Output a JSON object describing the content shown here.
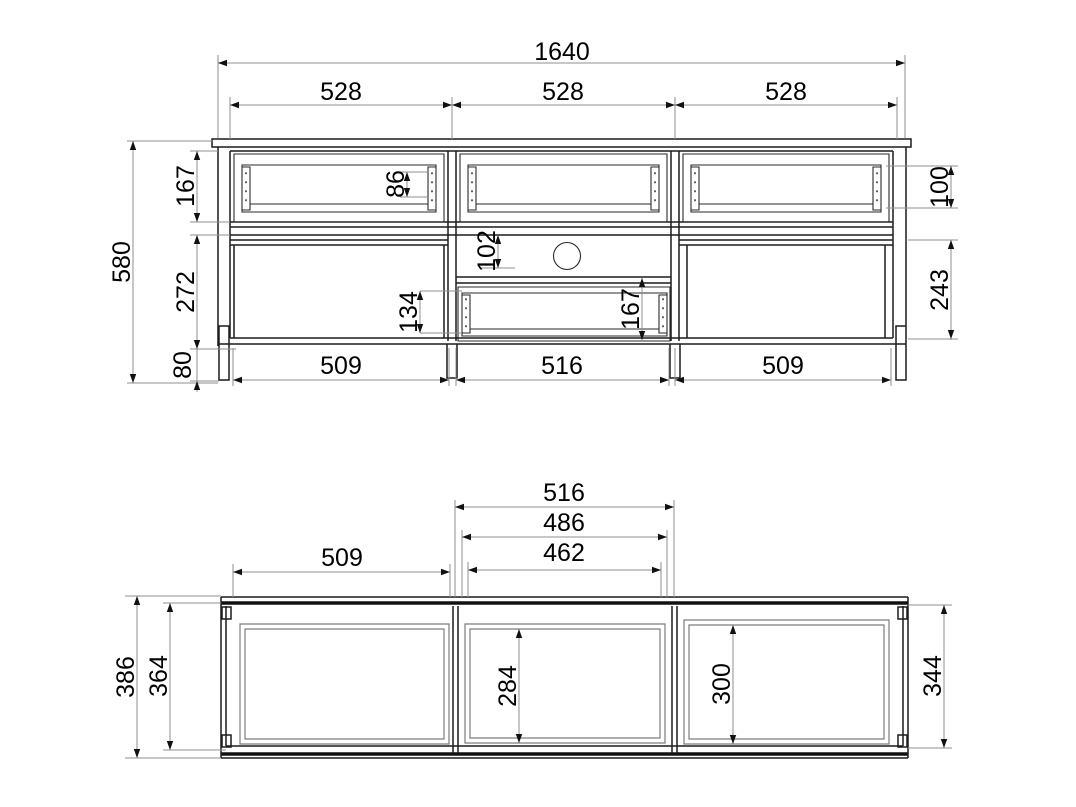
{
  "drawing": {
    "front_view": {
      "total_width": "1640",
      "section_widths": [
        "528",
        "528",
        "528"
      ],
      "total_height": "580",
      "top_section_height": "167",
      "middle_section_height": "272",
      "leg_height": "80",
      "drawer_rail_height": "86",
      "right_opening_height": "100",
      "cable_gap_height": "102",
      "drawer_front_height": "134",
      "lower_drawer_height": "167",
      "right_lower_height": "243",
      "bottom_widths": [
        "509",
        "516",
        "509"
      ]
    },
    "plan_view": {
      "middle_outer_width": "516",
      "middle_mid_width": "486",
      "middle_inner_width": "462",
      "left_width": "509",
      "total_depth": "386",
      "inner_depth": "364",
      "middle_door_depth": "284",
      "right_door_depth": "300",
      "right_inner_depth": "344"
    }
  }
}
